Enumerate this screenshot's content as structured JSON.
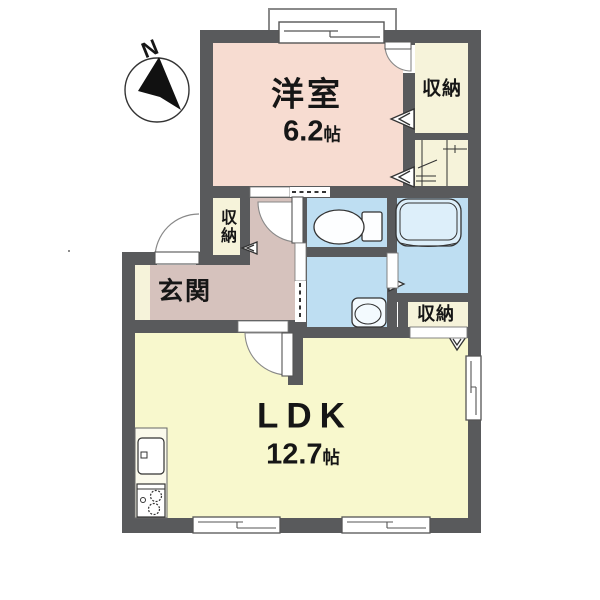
{
  "compass": {
    "north_label": "N"
  },
  "rooms": {
    "western_room": {
      "name": "洋室",
      "area_value": "6.2",
      "area_unit": "帖"
    },
    "ldk": {
      "name": "LDK",
      "area_value": "12.7",
      "area_unit": "帖"
    },
    "entrance": {
      "name": "玄関"
    },
    "storage_top_right": {
      "name": "収納"
    },
    "storage_hall": {
      "name": "収納"
    },
    "storage_bottom_right": {
      "name": "収納"
    }
  },
  "colors": {
    "wall": "#595a5c",
    "western": "#f7dcd1",
    "storage": "#f6f3da",
    "hall": "#d6c2bd",
    "wet": "#bedef2",
    "ldk": "#f8f8cd"
  }
}
